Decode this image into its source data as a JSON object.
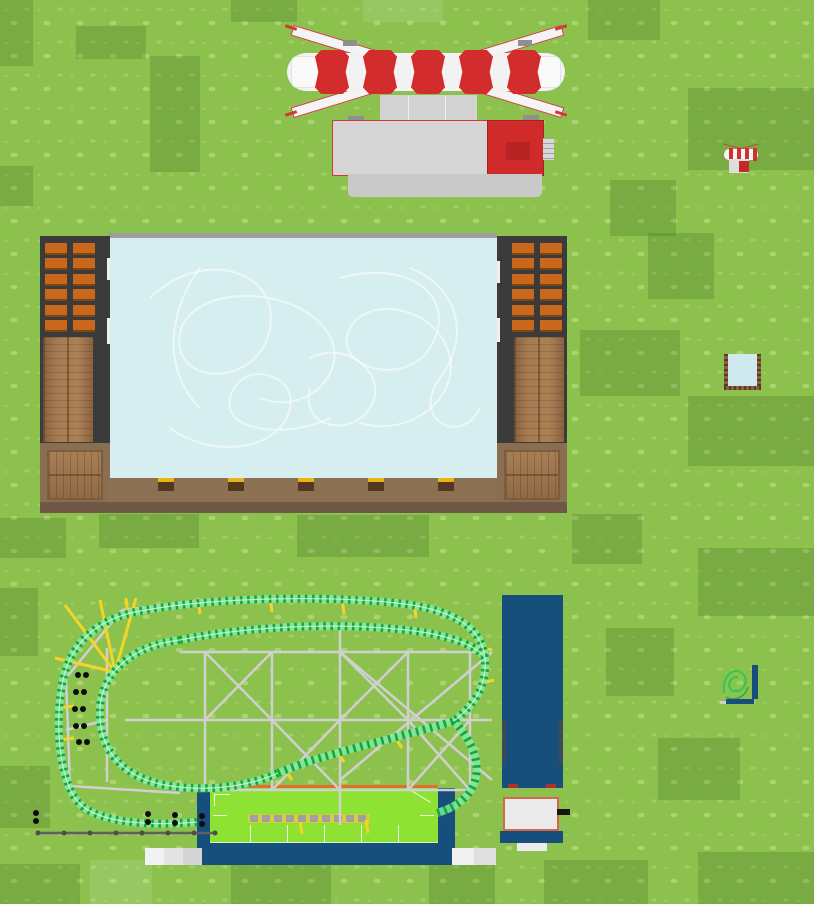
{
  "scene": {
    "name": "theme-park-overview-map",
    "objects": {
      "flat_ride": {
        "label": "Red and white flat ride"
      },
      "ice_rink": {
        "label": "Ice skating rink"
      },
      "roller_coaster": {
        "label": "Green roller coaster"
      },
      "coaster_station": {
        "label": "Roller coaster station"
      },
      "blue_building": {
        "label": "Tall dark blue building"
      },
      "kiosk": {
        "label": "Small shop kiosk"
      },
      "fence": {
        "label": "Queue fence"
      },
      "path_tiles": {
        "label": "Footpath tiles"
      },
      "thumb_flat_ride": {
        "label": "Flat ride miniature"
      },
      "thumb_ice_rink": {
        "label": "Ice rink miniature"
      },
      "thumb_coaster": {
        "label": "Roller coaster miniature"
      }
    },
    "colors": {
      "grass": "#8cc14e",
      "grass_patch_dark": "#7cb045",
      "ride_red": "#d22c2c",
      "platform_gray": "#d6d6d6",
      "ice": "#d7eef1",
      "wood": "#9b7149",
      "dark_wall": "#3b3b3b",
      "window_orange": "#c9681c",
      "walkway_brown": "#8b7052",
      "track_green": "#13a83c",
      "support_yellow": "#f5d427",
      "truss_gray": "#d0d0d0",
      "navy": "#174f7c",
      "station_roof_green": "#8ee233",
      "bench_yellow": "#e9b514"
    }
  }
}
